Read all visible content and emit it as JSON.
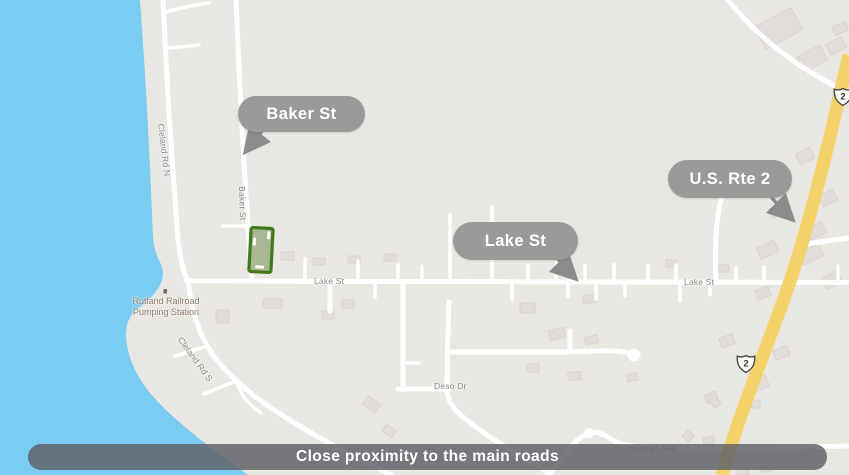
{
  "map": {
    "caption": "Close proximity to the main roads",
    "callouts": {
      "baker": "Baker St",
      "lake": "Lake St",
      "rte2": "U.S. Rte 2"
    },
    "street_labels": {
      "cleland_n": "Cleland Rd N",
      "baker_st": "Baker St",
      "lake_st_west": "Lake St",
      "lake_st_east": "Lake St",
      "cleland_s": "Cleland Rd S",
      "deso_dr": "Deso Dr",
      "horican_ave": "Horican Ave"
    },
    "poi": {
      "line1": "Rutland Railroad",
      "line2": "Pumping Station"
    },
    "route_shields": [
      {
        "number": "2"
      },
      {
        "number": "2"
      }
    ],
    "colors": {
      "water": "#7acdf0",
      "land": "#e9e7e2",
      "road": "#ffffff",
      "highway": "#f5d36a",
      "building": "#e1deda",
      "callout_bg": "#9a9a98",
      "caption_bg": "rgba(95,98,103,0.84)",
      "parcel_fill": "#aab795",
      "parcel_border": "#3f7a1d",
      "street_label_text": "#86857f",
      "poi_label_text": "#8d7a67"
    }
  }
}
